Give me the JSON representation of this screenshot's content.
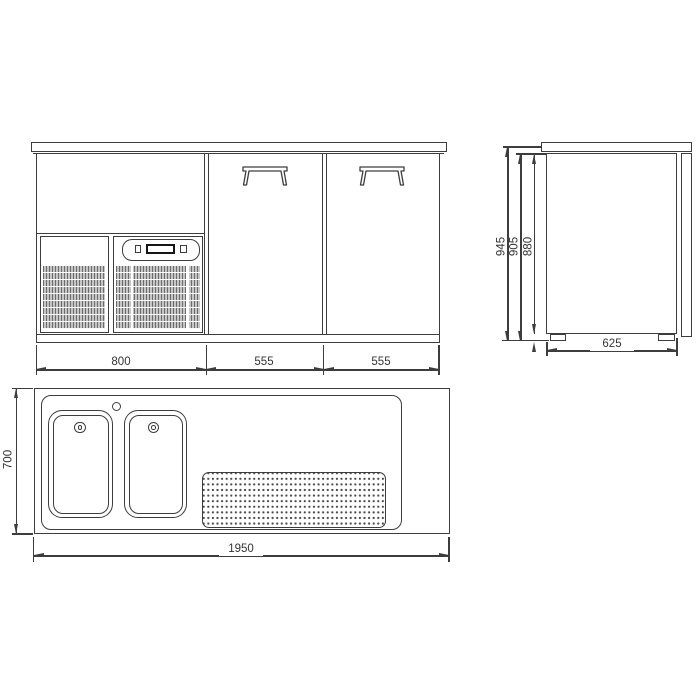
{
  "front_view": {
    "left_section_width": "800",
    "left_door_width": "555",
    "right_door_width": "555"
  },
  "side_view": {
    "overall_height": "945",
    "height_under_worktop": "905",
    "cabinet_height": "880",
    "depth": "625"
  },
  "top_view": {
    "overall_length": "1950",
    "overall_depth": "700"
  },
  "colors": {
    "line": "#3d3d3d",
    "text": "#333333",
    "grille_fill": "#c6c6c6",
    "display_outline": "#161616"
  }
}
